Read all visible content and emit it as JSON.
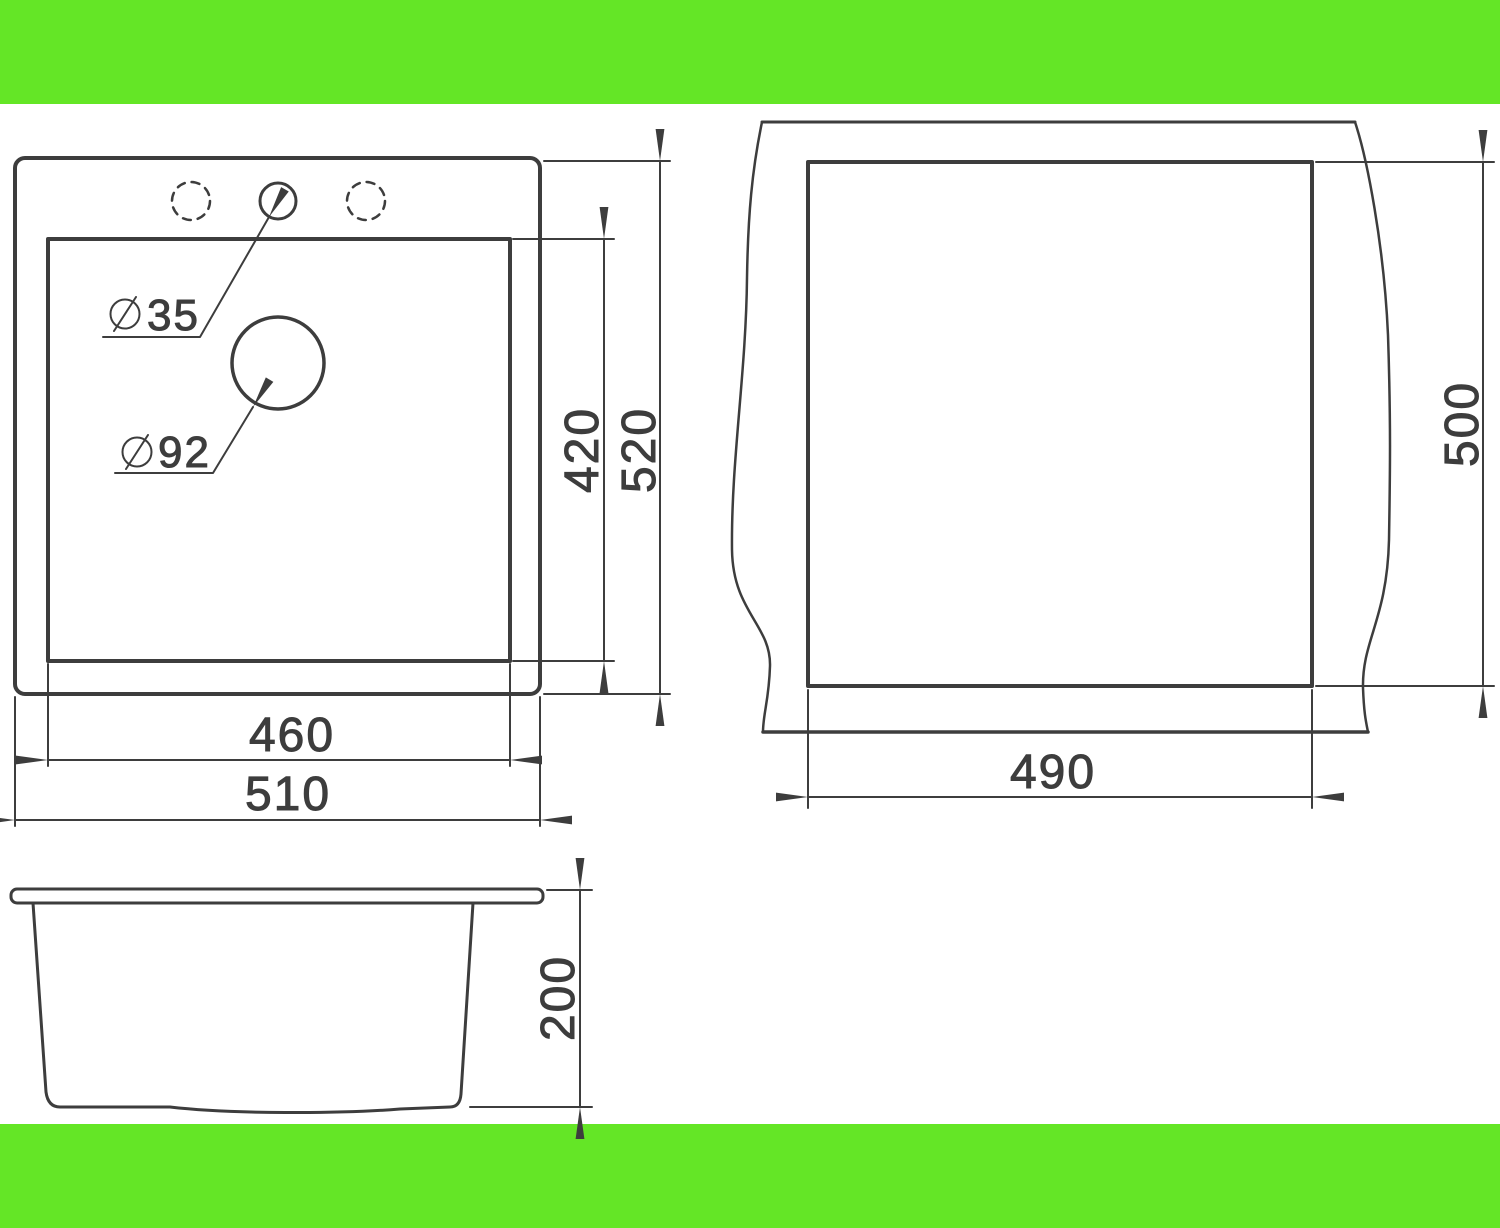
{
  "page": {
    "title": "Sink dimensional drawing",
    "background_color": "#ffffff",
    "accent_bar_color": "#64E626",
    "line_color": "#3D3D3D"
  },
  "views": {
    "top_view": {
      "name": "top view of sink",
      "labels": {
        "faucet_hole": {
          "symbol": "diameter",
          "value": "35"
        },
        "drain_hole": {
          "symbol": "diameter",
          "value": "92"
        },
        "inner_bowl_depth": "420",
        "outer_depth": "520",
        "inner_bowl_width": "460",
        "outer_width": "510"
      }
    },
    "cutout_view": {
      "name": "countertop cutout view",
      "labels": {
        "cutout_width": "490",
        "cutout_depth": "500"
      }
    },
    "side_view": {
      "name": "side profile view",
      "labels": {
        "bowl_height": "200"
      }
    }
  }
}
